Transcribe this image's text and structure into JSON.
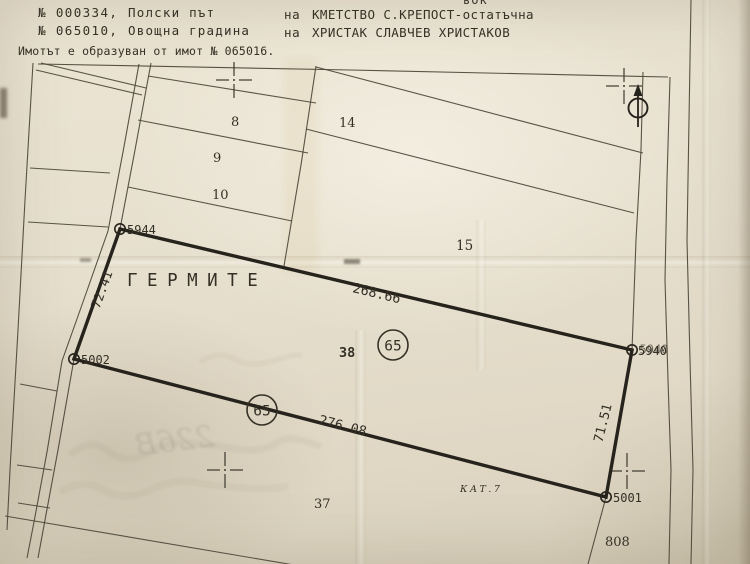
{
  "colors": {
    "paper": "#e7e0cf",
    "ink": "#343026",
    "thick_boundary": "#26231c",
    "thin_boundary": "#4c463a"
  },
  "header": {
    "top_fragment": "вок",
    "line1": {
      "number": "№ 000334,",
      "land_use": "Полски път",
      "prep": "на",
      "owner": "КМЕТСТВО С.КРЕПОСТ-остатъчна"
    },
    "line2": {
      "number": "№ 065010,",
      "land_use": "Овощна градина",
      "prep": "на",
      "owner": "ХРИСТАК СЛАВЧЕВ ХРИСТАКОВ"
    },
    "note": "Имотът е образуван от имот № 065016."
  },
  "map": {
    "locality": "ГЕРМИТЕ",
    "category": "КАТ.7",
    "main_parcel": {
      "number": "65",
      "block": "38"
    },
    "parcel_labels": {
      "p8": "8",
      "p9": "9",
      "p10": "10",
      "p14": "14",
      "p15": "15",
      "p37": "37",
      "p808": "808"
    },
    "point_labels": {
      "nw": "5944",
      "sw": "5002",
      "ne": "5940",
      "se": "5001"
    },
    "side_lengths": {
      "north": "268.66",
      "south": "276.08",
      "west": "72.41",
      "east": "71.51"
    },
    "bleedthrough_fragment": "226В"
  }
}
